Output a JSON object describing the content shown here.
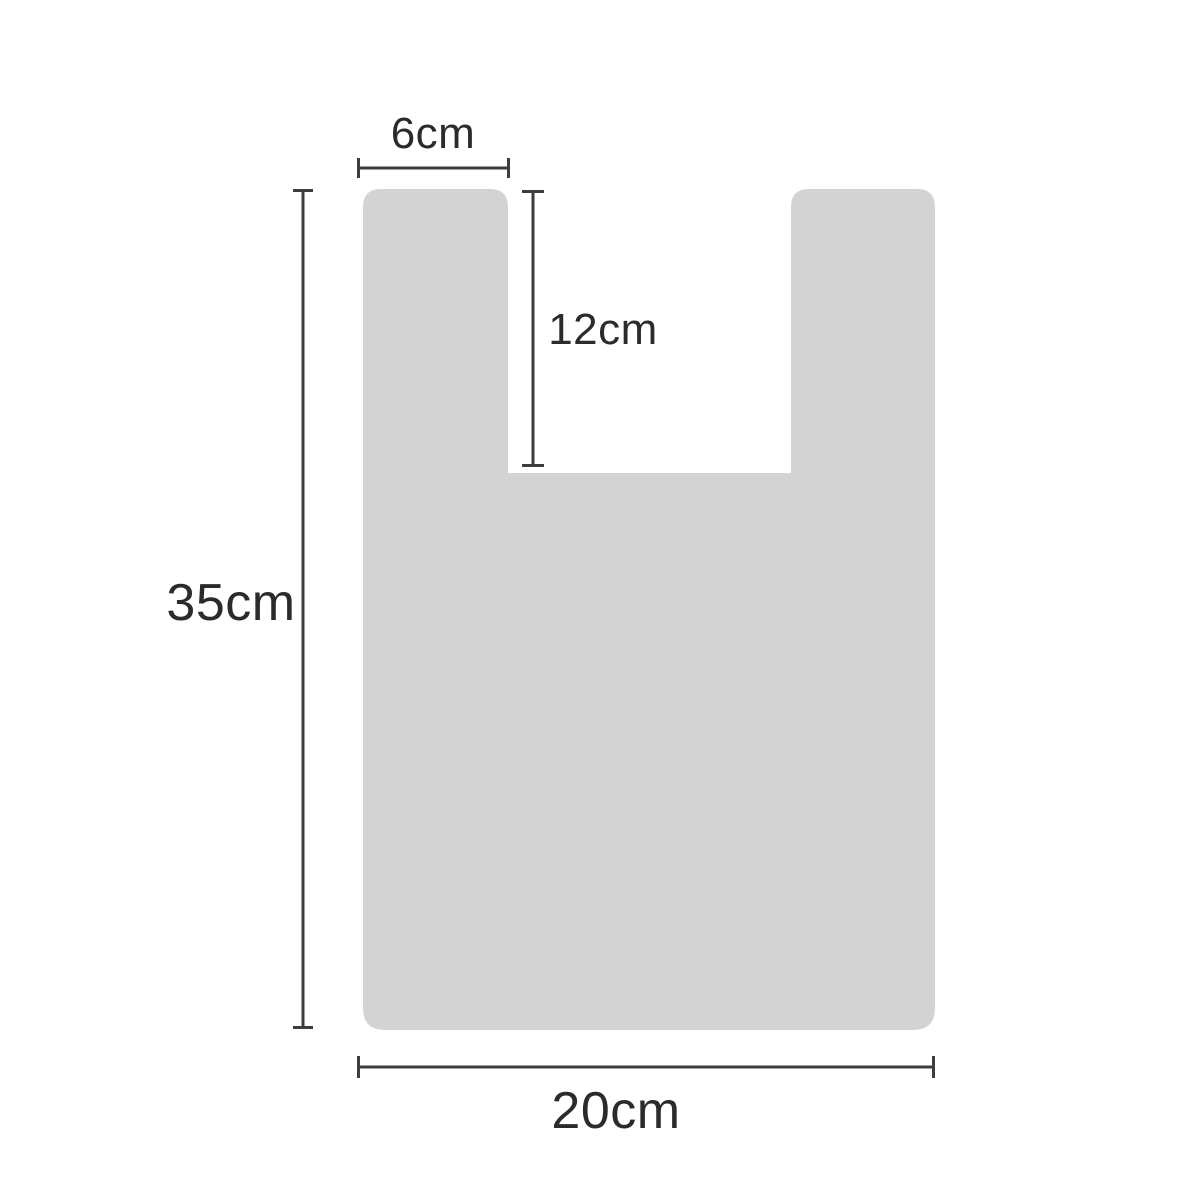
{
  "page": {
    "description": "Dimension diagram of a T-shirt style vest bag shape",
    "background": "#ffffff"
  },
  "colors": {
    "bag_fill": "#d3d3d3",
    "line": "#3d3d3d",
    "text": "#2b2b2b"
  },
  "diagram": {
    "shape": "t-shirt-bag-outline",
    "labels": {
      "handle_width": "6cm",
      "notch_depth": "12cm",
      "bag_height": "35cm",
      "bag_width": "20cm"
    },
    "measurements": [
      {
        "name": "handle-width",
        "value": "6cm",
        "orientation": "horizontal",
        "position": "top-left"
      },
      {
        "name": "notch-depth",
        "value": "12cm",
        "orientation": "vertical",
        "position": "center-upper"
      },
      {
        "name": "bag-height",
        "value": "35cm",
        "orientation": "vertical",
        "position": "left"
      },
      {
        "name": "bag-width",
        "value": "20cm",
        "orientation": "horizontal",
        "position": "bottom"
      }
    ]
  }
}
